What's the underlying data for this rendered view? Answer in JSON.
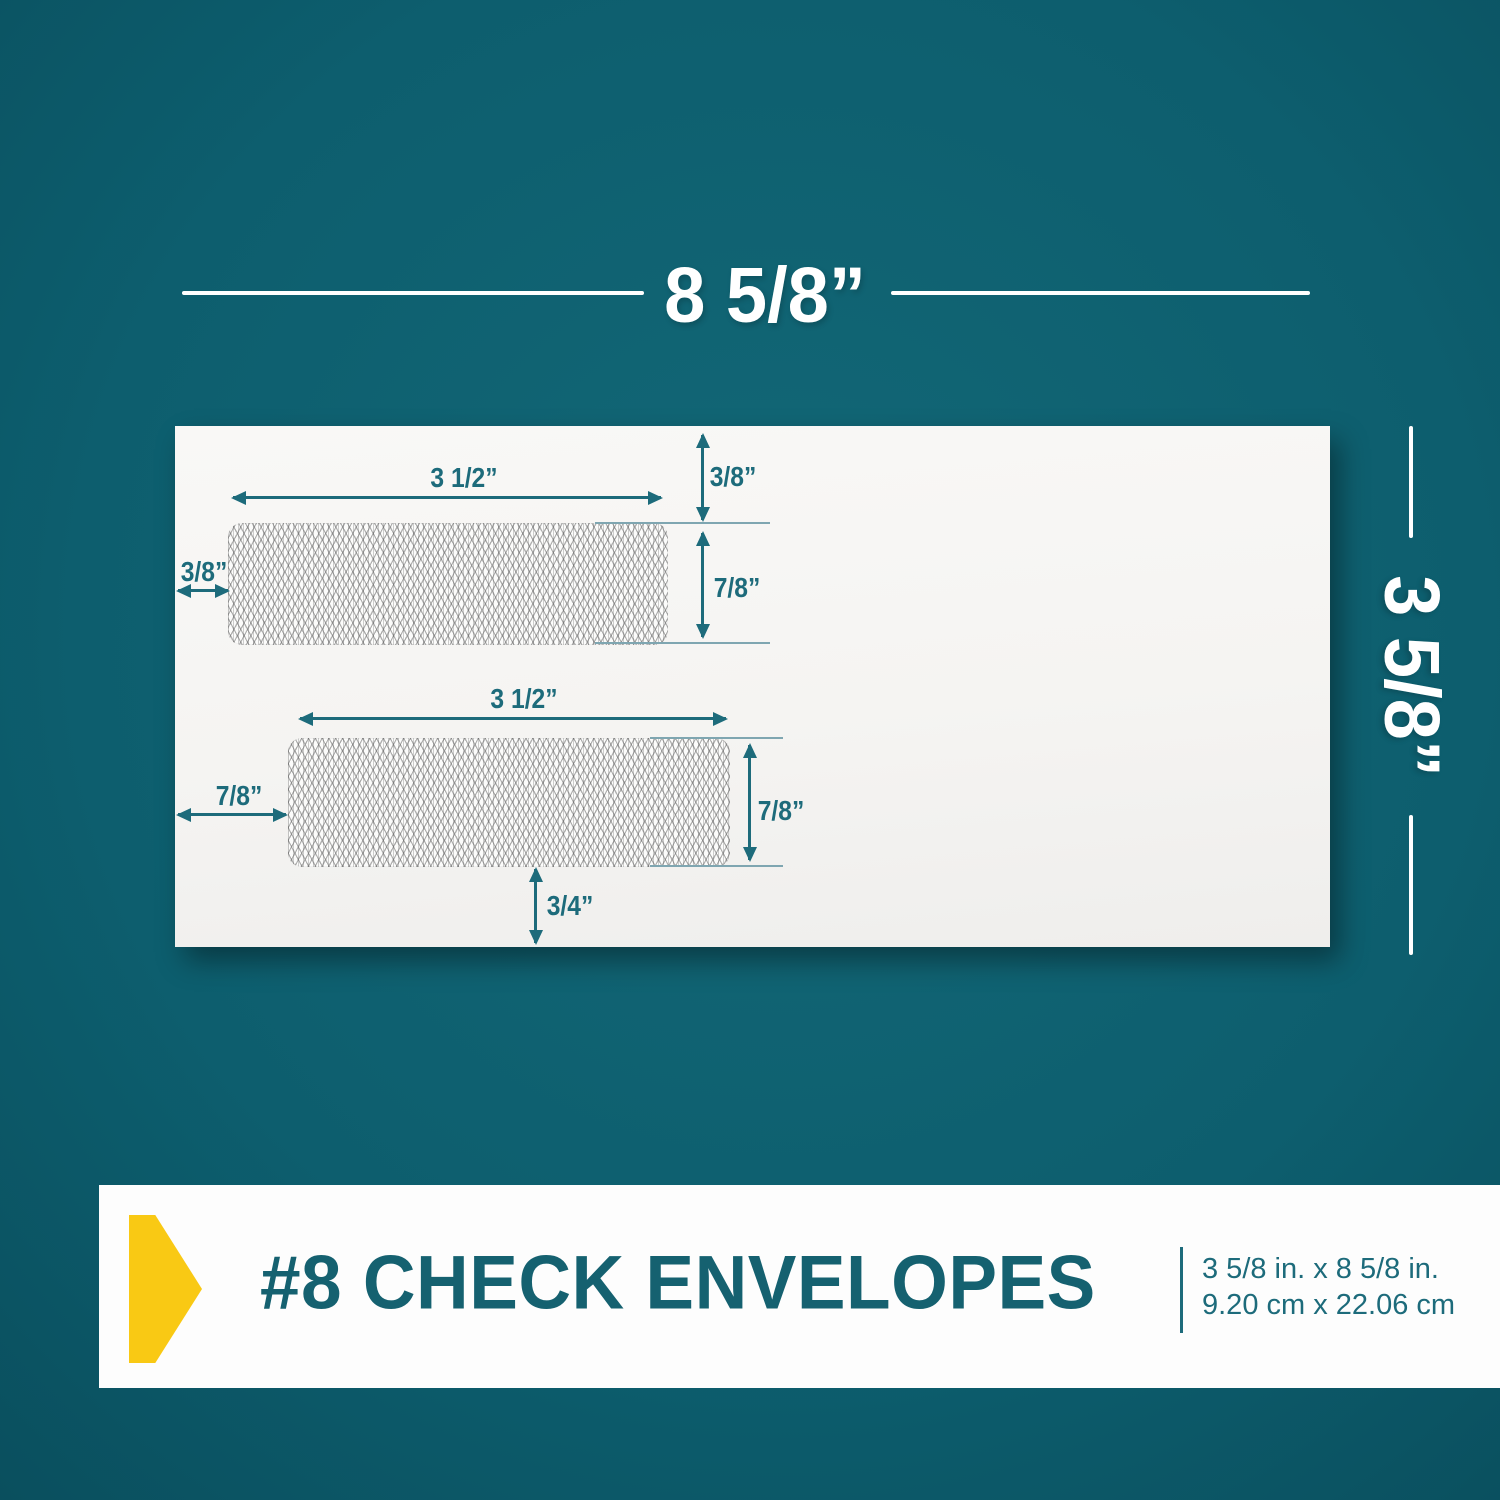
{
  "colors": {
    "background": "#0d5e6e",
    "accent_teal": "#1d6b7b",
    "title_teal": "#156170",
    "ext_line": "#7fa6b1",
    "yellow": "#f9c914",
    "band_white": "#fdfdfd",
    "envelope_white": "#f5f4f2"
  },
  "dimensions": {
    "width_label": "8 5/8”",
    "height_label": "3 5/8”"
  },
  "envelope": {
    "annotations": {
      "top_window_width": "3 1/2”",
      "top_window_top_margin": "3/8”",
      "top_window_left_margin": "3/8”",
      "top_window_height": "7/8”",
      "bottom_window_width": "3 1/2”",
      "bottom_window_left_margin": "7/8”",
      "bottom_window_height": "7/8”",
      "bottom_window_bottom_margin": "3/4”"
    }
  },
  "banner": {
    "title": "#8 CHECK ENVELOPES",
    "size_inches": "3 5/8 in. x 8 5/8 in.",
    "size_cm": "9.20 cm x 22.06 cm"
  }
}
